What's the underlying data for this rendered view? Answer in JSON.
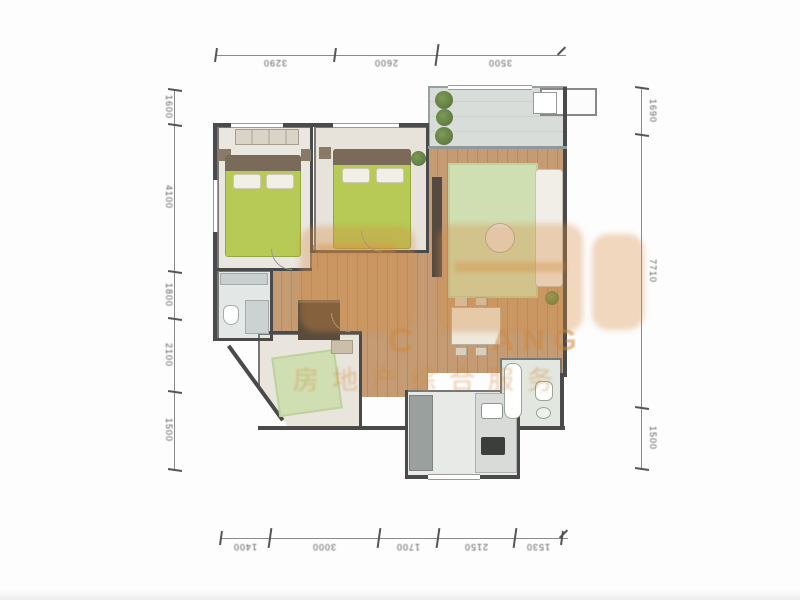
{
  "dims": {
    "top": [
      "3290",
      "2600",
      "3500"
    ],
    "bottom": [
      "1400",
      "3000",
      "1700",
      "2150",
      "1530"
    ],
    "left": [
      "1600",
      "4100",
      "1800",
      "2100",
      "1500"
    ],
    "right": [
      "1690",
      "7710",
      "1500"
    ]
  },
  "watermark": {
    "latin_left": "C",
    "latin_right": "ANG",
    "tagline": "房地产综合服务",
    "color": "#d68e42"
  },
  "colors": {
    "wall": "#4a4a4a",
    "wood_floor": "#c79a6e",
    "bed_green": "#b6cb4c",
    "rug_green": "#cfe0af",
    "balcony_tile": "#d9ddd9",
    "bedroom_floor": "#eae7df"
  }
}
